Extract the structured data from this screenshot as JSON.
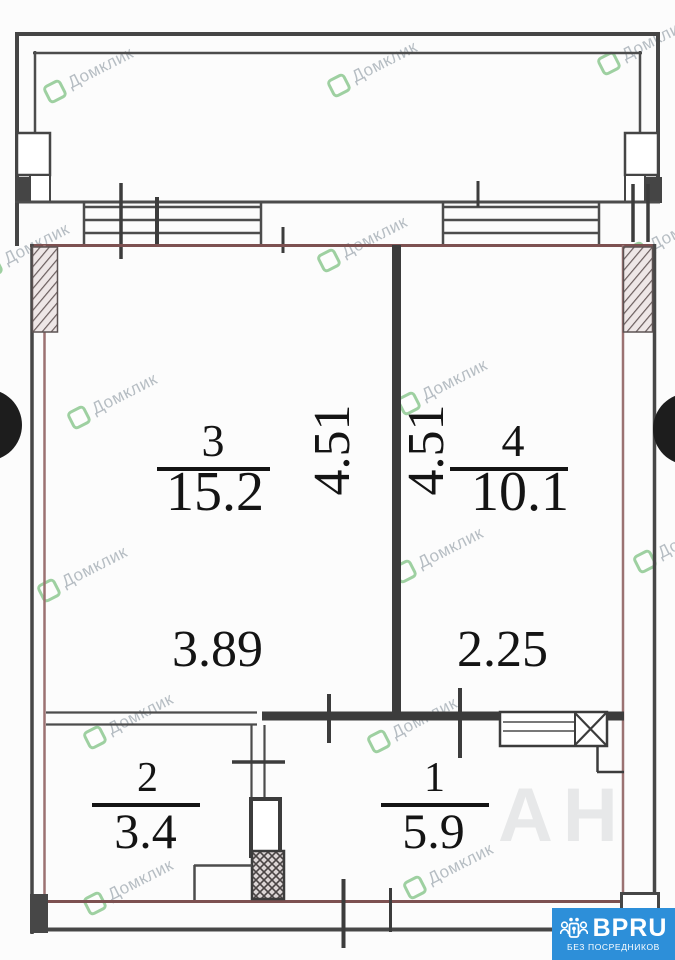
{
  "plan": {
    "rooms": [
      {
        "number": "3",
        "area": "15.2"
      },
      {
        "number": "4",
        "area": "10.1"
      },
      {
        "number": "2",
        "area": "3.4"
      },
      {
        "number": "1",
        "area": "5.9"
      }
    ],
    "dims": {
      "room3_height": "4.51",
      "room4_height": "4.51",
      "room3_width": "3.89",
      "room4_width": "2.25"
    }
  },
  "watermark": {
    "text": "Домклик",
    "faint_text": "АН"
  },
  "badge": {
    "brand": "BPRU",
    "tagline": "БЕЗ ПОСРЕДНИКОВ"
  },
  "colors": {
    "badge_bg": "#2d8fd9",
    "watermark_green": "#52ad57",
    "outer_wall_brown": "#8a5c5c",
    "wall_dark": "#3c3c3c"
  }
}
